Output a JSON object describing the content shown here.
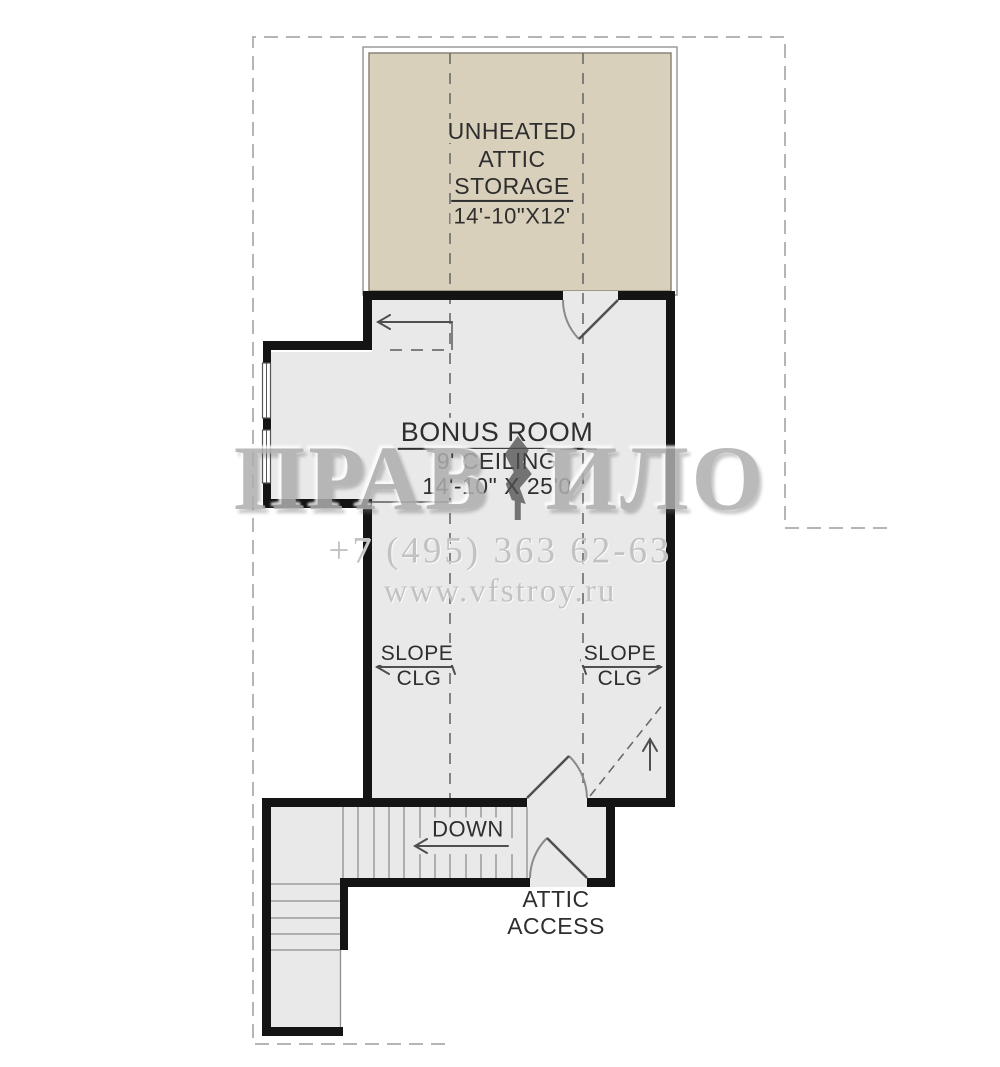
{
  "floorplan": {
    "attic_storage": {
      "label_line1": "UNHEATED",
      "label_line2": "ATTIC",
      "label_line3": "STORAGE",
      "dimensions": "14'-10\"X12'"
    },
    "bonus_room": {
      "name": "BONUS ROOM",
      "ceiling": "9' CEILING",
      "dimensions": "14'-10\" X 25'0"
    },
    "slope_left": {
      "line1": "SLOPE",
      "line2": "CLG"
    },
    "slope_right": {
      "line1": "SLOPE",
      "line2": "CLG"
    },
    "stairs": {
      "down_label": "DOWN"
    },
    "attic_access": {
      "line1": "ATTIC",
      "line2": "ACCESS"
    }
  },
  "watermark": {
    "brand_left": "ПРАВ",
    "brand_right": "ИЛО",
    "phone": "+7 (495) 363 62-63",
    "website": "www.vfstroy.ru"
  },
  "colors": {
    "storage_fill": "#d8d0bb",
    "floor_fill": "#e9e9e9",
    "wall": "#141414",
    "roof_dash": "#b5b5b5",
    "interior_dash": "#6a6a6a",
    "watermark_text": "#c2c2c2",
    "label_text": "#2e2e2e"
  }
}
